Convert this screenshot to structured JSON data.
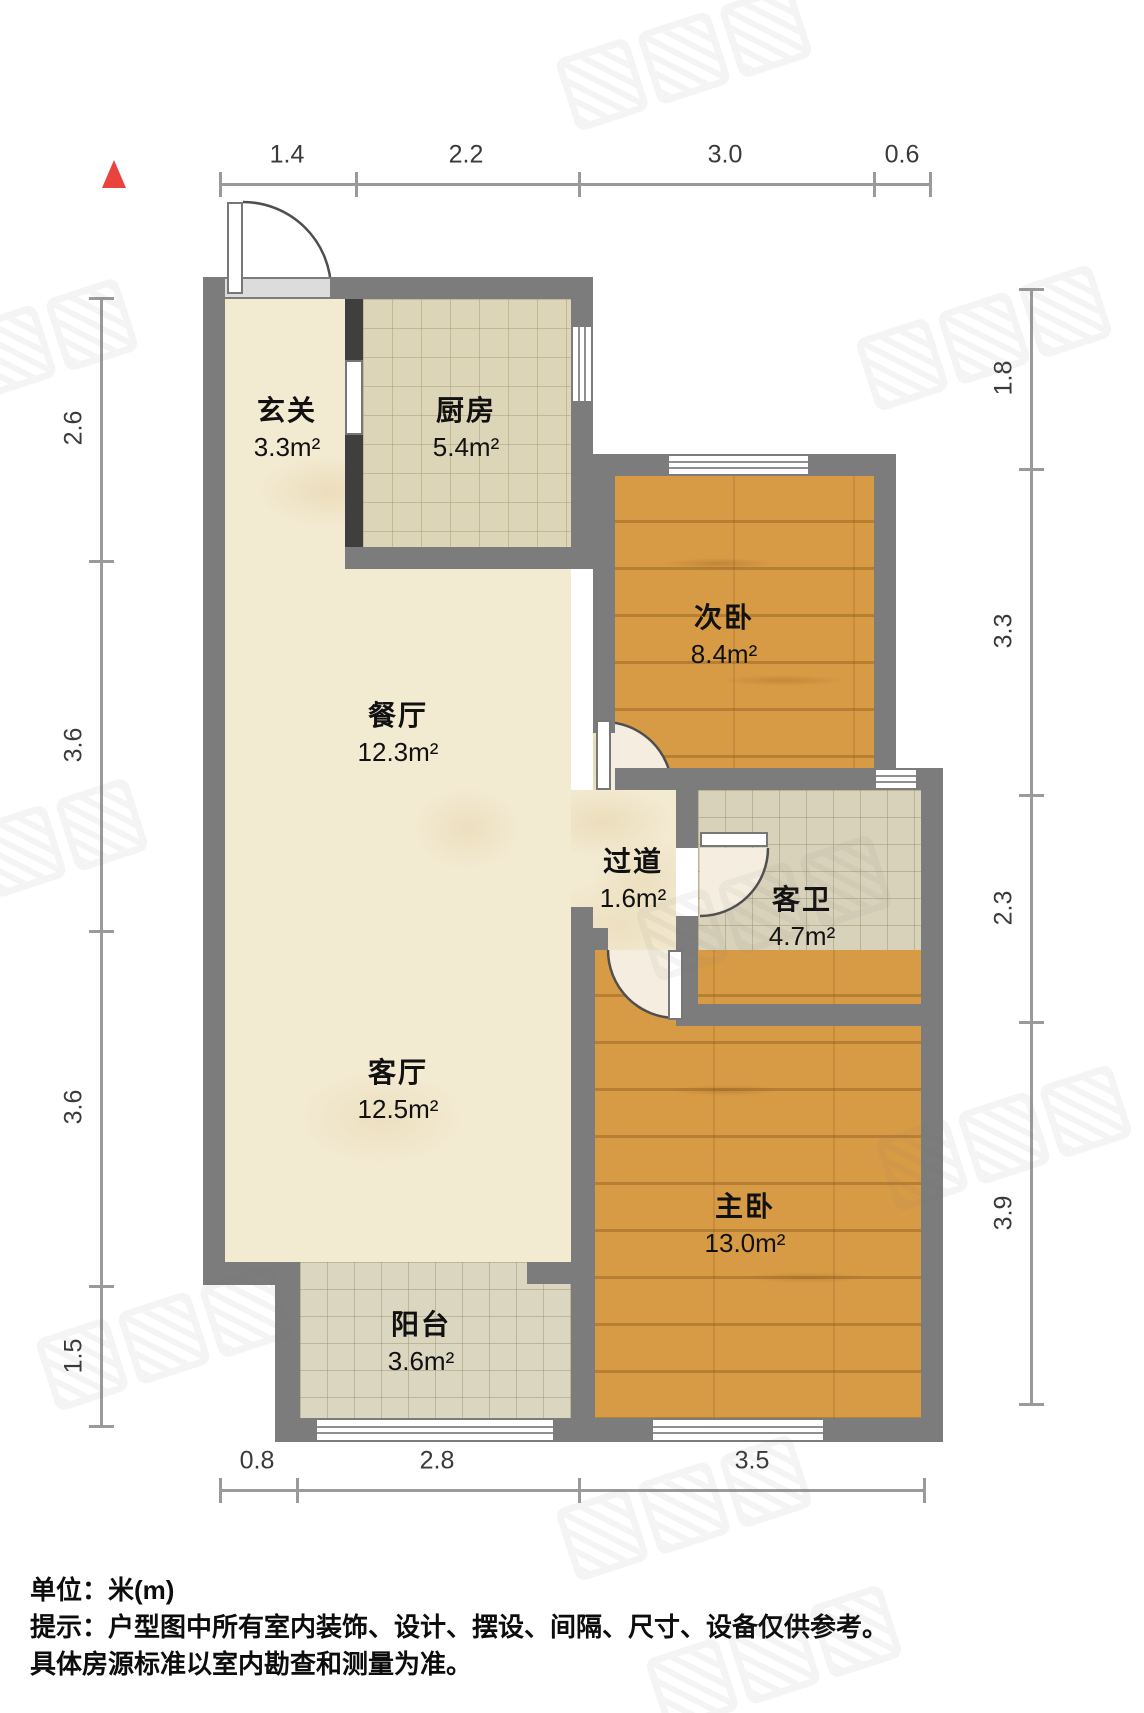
{
  "plan": {
    "type": "apartment-floorplan",
    "unit_scale": "meters"
  },
  "rooms": [
    {
      "name": "玄关",
      "area": "3.3m²"
    },
    {
      "name": "厨房",
      "area": "5.4m²"
    },
    {
      "name": "次卧",
      "area": "8.4m²"
    },
    {
      "name": "餐厅",
      "area": "12.3m²"
    },
    {
      "name": "过道",
      "area": "1.6m²"
    },
    {
      "name": "客卫",
      "area": "4.7m²"
    },
    {
      "name": "客厅",
      "area": "12.5m²"
    },
    {
      "name": "主卧",
      "area": "13.0m²"
    },
    {
      "name": "阳台",
      "area": "3.6m²"
    }
  ],
  "dimensions": {
    "top": [
      "1.4",
      "2.2",
      "3.0",
      "0.6"
    ],
    "left": [
      "2.6",
      "3.6",
      "3.6",
      "1.5"
    ],
    "right": [
      "1.8",
      "3.3",
      "2.3",
      "3.9"
    ],
    "bottom": [
      "0.8",
      "2.8",
      "3.5"
    ]
  },
  "footer": {
    "unit": "单位：米(m)",
    "tip1": "提示：户型图中所有室内装饰、设计、摆设、间隔、尺寸、设备仅供参考。",
    "tip2": "具体房源标准以室内勘查和测量为准。"
  },
  "colors": {
    "wall": "#7c7c7c",
    "wood_floor": "#d89b45",
    "tile_floor": "#ddd5b8",
    "cream_floor": "#f3ead2",
    "north_arrow": "#e8433c",
    "dimension_line": "#9a9a9a"
  }
}
